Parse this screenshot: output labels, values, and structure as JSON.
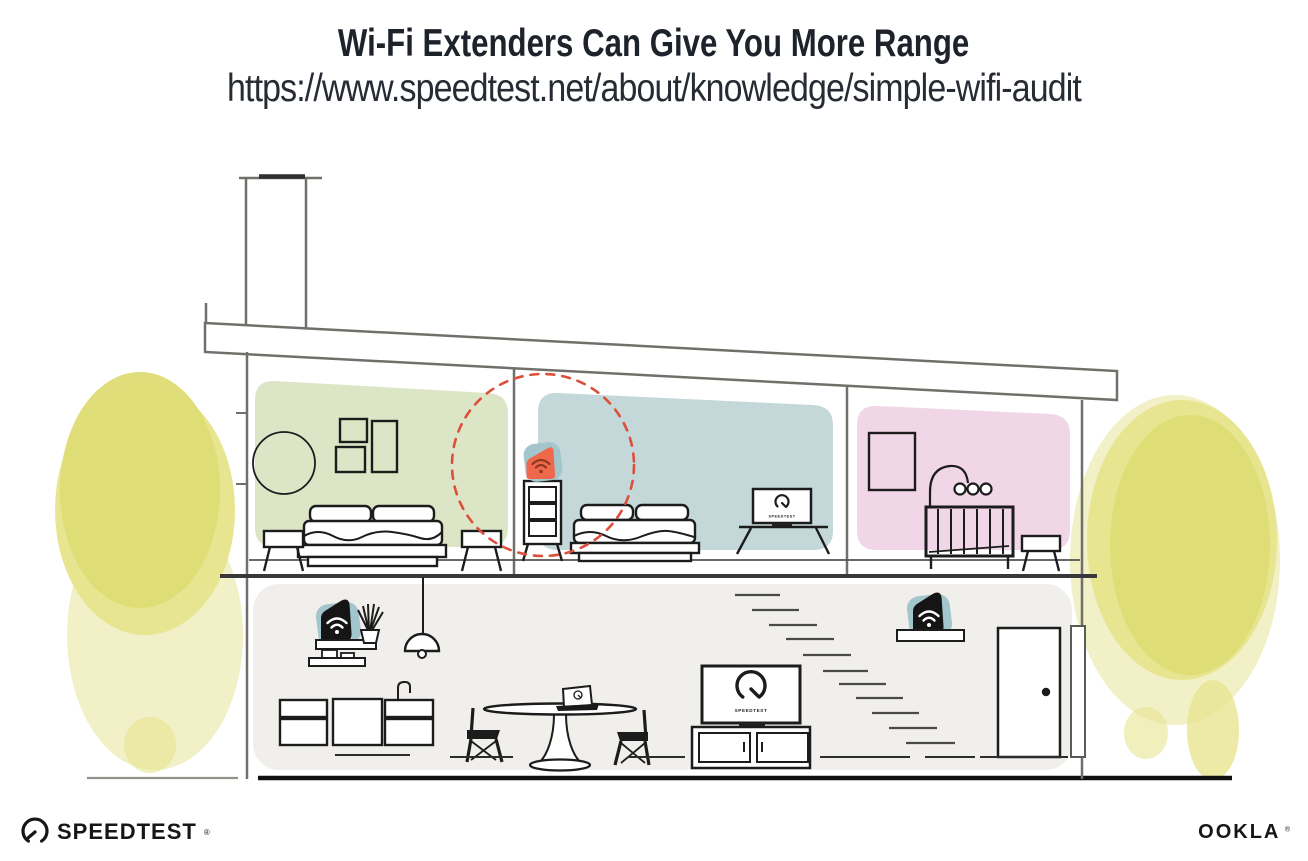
{
  "header": {
    "title": "Wi-Fi Extenders Can Give You More Range",
    "url": "https://www.speedtest.net/about/knowledge/simple-wifi-audit"
  },
  "house": {
    "tv_screen_label": "SPEEDTEST"
  },
  "branding": {
    "speedtest_wordmark": "SPEEDTEST",
    "speedtest_reg": "®",
    "ookla_wordmark": "OOKLA",
    "ookla_reg": "®"
  },
  "colors": {
    "ink": "#1d222b",
    "subtitle_ink": "#272c34",
    "wall_line": "#70706b",
    "furniture_line": "#1c1c1c",
    "room_green": "#dce6c6",
    "room_blue": "#c4d8da",
    "room_pink": "#f1d6e7",
    "floor_grey": "#f0efec",
    "tree_core": "#dedc74",
    "tree_mid": "#e7e590",
    "tree_light": "#f1f0c6",
    "extender_teal": "#a3c6cc",
    "extender_orange": "#f0684b",
    "wifi_dark": "#8f3720",
    "device_black": "#151515",
    "range_red": "#dc4f3b"
  }
}
